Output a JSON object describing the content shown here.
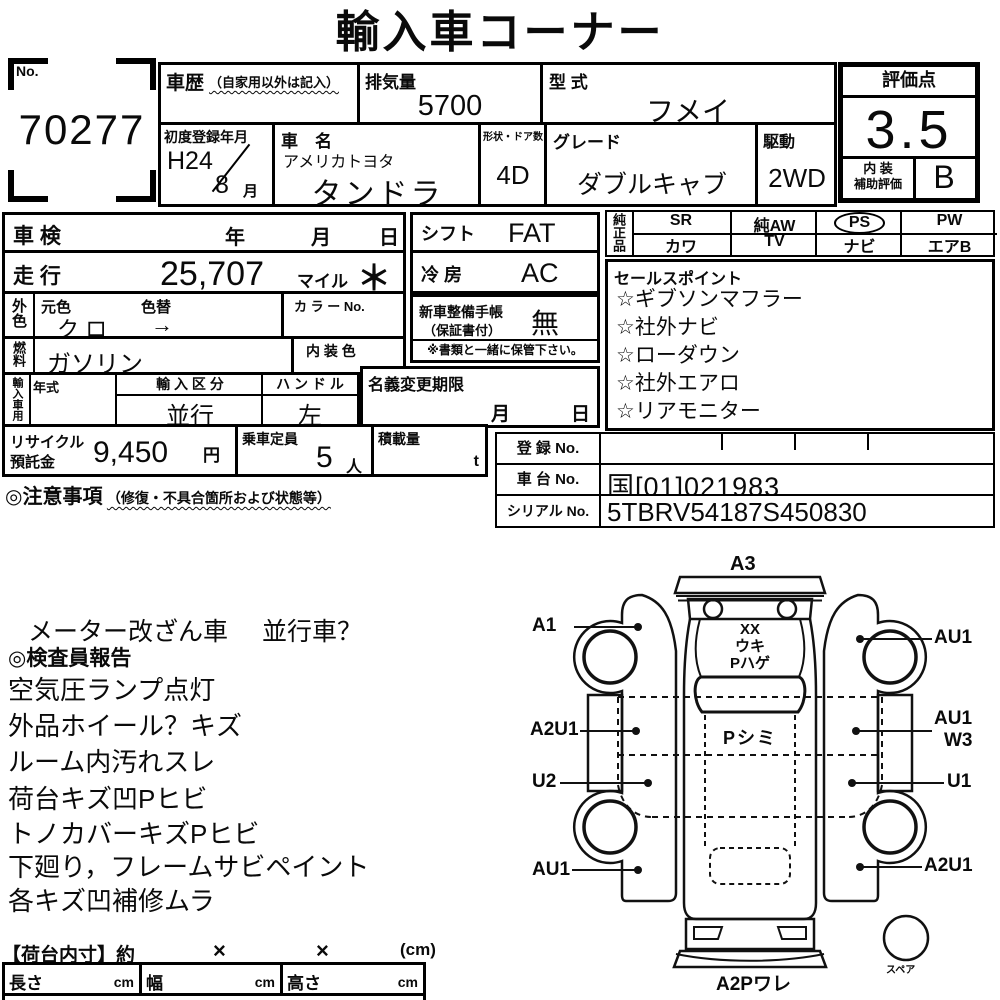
{
  "title": "輸入車コーナー",
  "lot_no": {
    "label": "No.",
    "value": "70277"
  },
  "history": {
    "label": "車歴",
    "note": "（自家用以外は記入）"
  },
  "displacement": {
    "label": "排気量",
    "value": "5700"
  },
  "model_code": {
    "label": "型 式",
    "value": "フメイ"
  },
  "first_registration": {
    "label": "初度登録年月",
    "year": "H24",
    "month": "8",
    "month_unit": "月"
  },
  "car_name": {
    "label": "車　名",
    "maker": "アメリカトヨタ",
    "model": "タンドラ"
  },
  "body_doors": {
    "label": "形状・ドア数",
    "value": "4D"
  },
  "grade": {
    "label": "グレード",
    "value": "ダブルキャブ"
  },
  "drive": {
    "label": "駆動",
    "value": "2WD"
  },
  "rating": {
    "label": "評価点",
    "score": "3.5",
    "interior_label_top": "内 装",
    "interior_label_bottom": "補助評価",
    "interior_grade": "B"
  },
  "shaken": {
    "label": "車 検",
    "year_unit": "年",
    "month_unit": "月",
    "day_unit": "日"
  },
  "mileage": {
    "label": "走 行",
    "value": "25,707",
    "unit": "マイル",
    "mark": "＊"
  },
  "exterior_color": {
    "label": "外色",
    "original_label": "元色",
    "original_value": "ク ロ",
    "repaint_label": "色替",
    "repaint_mark": "→",
    "color_no_label": "カ ラ ー No."
  },
  "fuel": {
    "label": "燃料",
    "value": "ガソリン",
    "interior_color_label": "内 装 色"
  },
  "import_use": {
    "label": "輸入車用",
    "year_label": "年式",
    "division_label": "輸 入 区 分",
    "division_value": "並行",
    "handle_label": "ハ ン ド ル",
    "handle_value": "左"
  },
  "shift": {
    "label": "シフト",
    "value": "FAT"
  },
  "aircon": {
    "label": "冷 房",
    "value": "AC"
  },
  "service_book": {
    "label_line1": "新車整備手帳",
    "label_line2": "（保証書付）",
    "value": "無",
    "note": "※書類と一緒に保管下さい。"
  },
  "name_change": {
    "label": "名義変更期限",
    "month_unit": "月",
    "day_unit": "日"
  },
  "recycle_deposit": {
    "label_line1": "リサイクル",
    "label_line2": "預託金",
    "value": "9,450",
    "unit": "円"
  },
  "seating": {
    "label": "乗車定員",
    "value": "5",
    "unit": "人"
  },
  "load_capacity": {
    "label": "積載量",
    "unit": "t"
  },
  "genuine_parts": {
    "label": "純正品",
    "row1": [
      "SR",
      "純AW",
      "PS",
      "PW"
    ],
    "row2": [
      "カワ",
      "TV",
      "ナビ",
      "エアB"
    ],
    "circled_item": "PS"
  },
  "sales_points": {
    "label": "セールスポイント",
    "items": [
      "☆ギブソンマフラー",
      "☆社外ナビ",
      "☆ローダウン",
      "☆社外エアロ",
      "☆リアモニター"
    ]
  },
  "registration": {
    "reg_label": "登 録 No.",
    "chassis_label": "車 台 No.",
    "chassis_value": "国[01]021983",
    "serial_label": "シリアル No.",
    "serial_value": "5TBRV54187S450830"
  },
  "caution": {
    "label": "◎注意事項",
    "note": "（修復・不具合箇所および状態等）"
  },
  "inspector_report": {
    "meter_note": "メーター改ざん車",
    "parallel_note": "並行車？",
    "header": "◎検査員報告",
    "items": [
      "空気圧ランプ点灯",
      "外品ホイール？キズ",
      "ルーム内汚れスレ",
      "荷台キズ凹Pヒビ",
      "トノカバーキズPヒビ",
      "下廻り，フレームサビペイント",
      "各キズ凹補修ムラ"
    ]
  },
  "bed_dimensions": {
    "title": "【荷台内寸】約",
    "times1": "×",
    "times2": "×",
    "unit_note": "(cm)",
    "length_label": "長さ",
    "length_unit": "cm",
    "width_label": "幅",
    "width_unit": "cm",
    "height_label": "高さ",
    "height_unit": "cm"
  },
  "diagram": {
    "a3": "A3",
    "a1": "A1",
    "au1_top_right": "AU1",
    "a2u1_mid_left": "A2U1",
    "au1_mid_right": "AU1",
    "w3_mid_right": "W3",
    "u2_left": "U2",
    "u1_right": "U1",
    "au1_bottom_left": "AU1",
    "a2u1_bottom_right": "A2U1",
    "a2p_bottom": "A2Pワレ",
    "spare_label": "スペア",
    "hood_line1": "XX",
    "hood_line2": "ウキ",
    "hood_line3": "Pハゲ",
    "roof_note": "Pシミ"
  }
}
